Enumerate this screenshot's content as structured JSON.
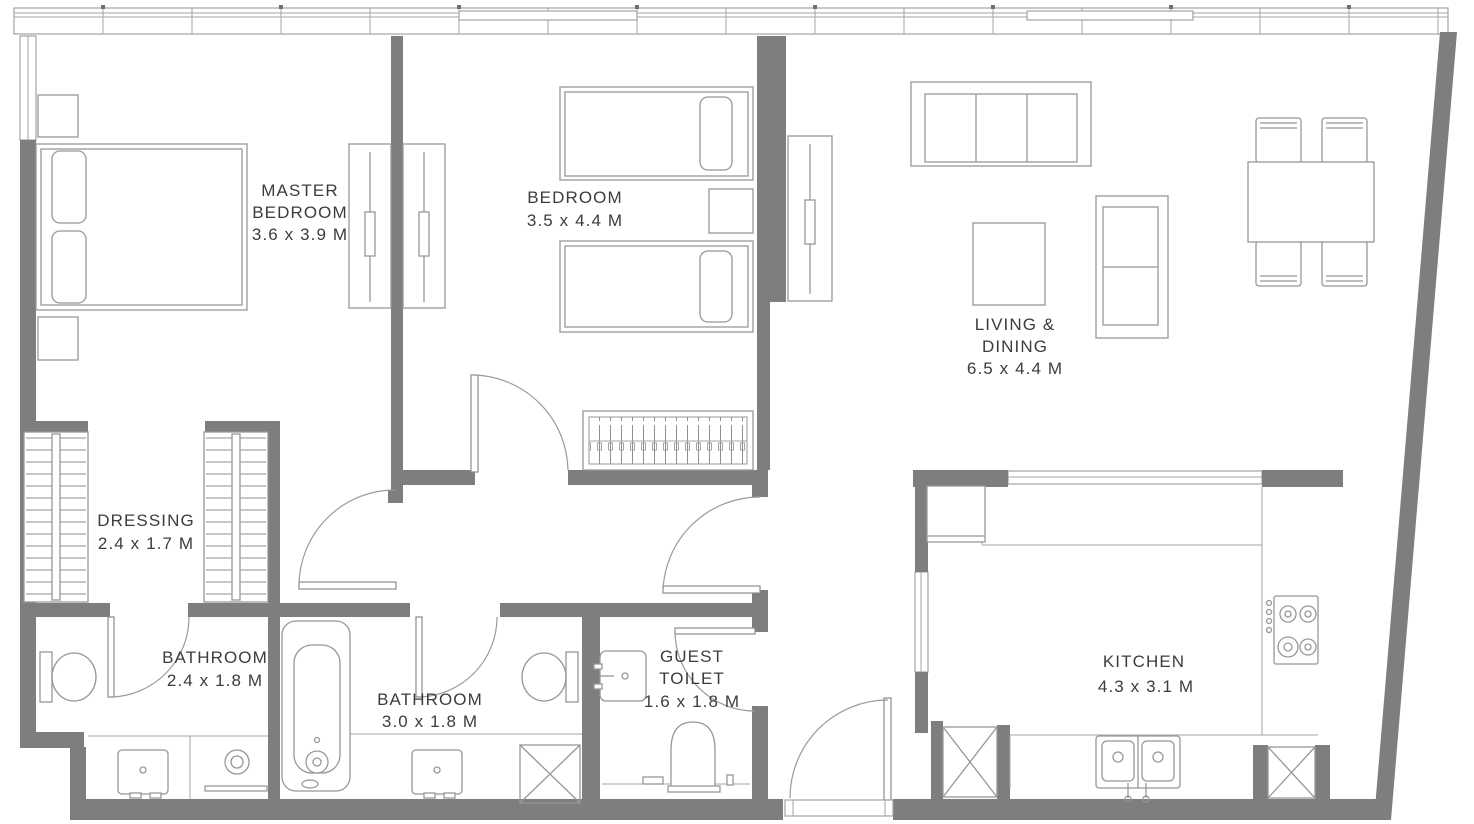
{
  "plan": {
    "rooms": {
      "master_bedroom": {
        "name_line1": "MASTER",
        "name_line2": "BEDROOM",
        "dims": "3.6 x 3.9 M"
      },
      "bedroom": {
        "name_line1": "BEDROOM",
        "dims": "3.5 x 4.4 M"
      },
      "living_dining": {
        "name_line1": "LIVING &",
        "name_line2": "DINING",
        "dims": "6.5 x 4.4 M"
      },
      "dressing": {
        "name_line1": "DRESSING",
        "dims": "2.4 x 1.7 M"
      },
      "bathroom_master": {
        "name_line1": "BATHROOM",
        "dims": "2.4 x 1.8 M"
      },
      "bathroom_main": {
        "name_line1": "BATHROOM",
        "dims": "3.0 x 1.8 M"
      },
      "guest_toilet": {
        "name_line1": "GUEST",
        "name_line2": "TOILET",
        "dims": "1.6 x 1.8 M"
      },
      "kitchen": {
        "name_line1": "KITCHEN",
        "dims": "4.3 x 3.1 M"
      }
    },
    "colors": {
      "wall": "#7e7e7e",
      "furniture_line": "#979797",
      "label_text": "#3c3c3c",
      "background": "#ffffff"
    }
  }
}
